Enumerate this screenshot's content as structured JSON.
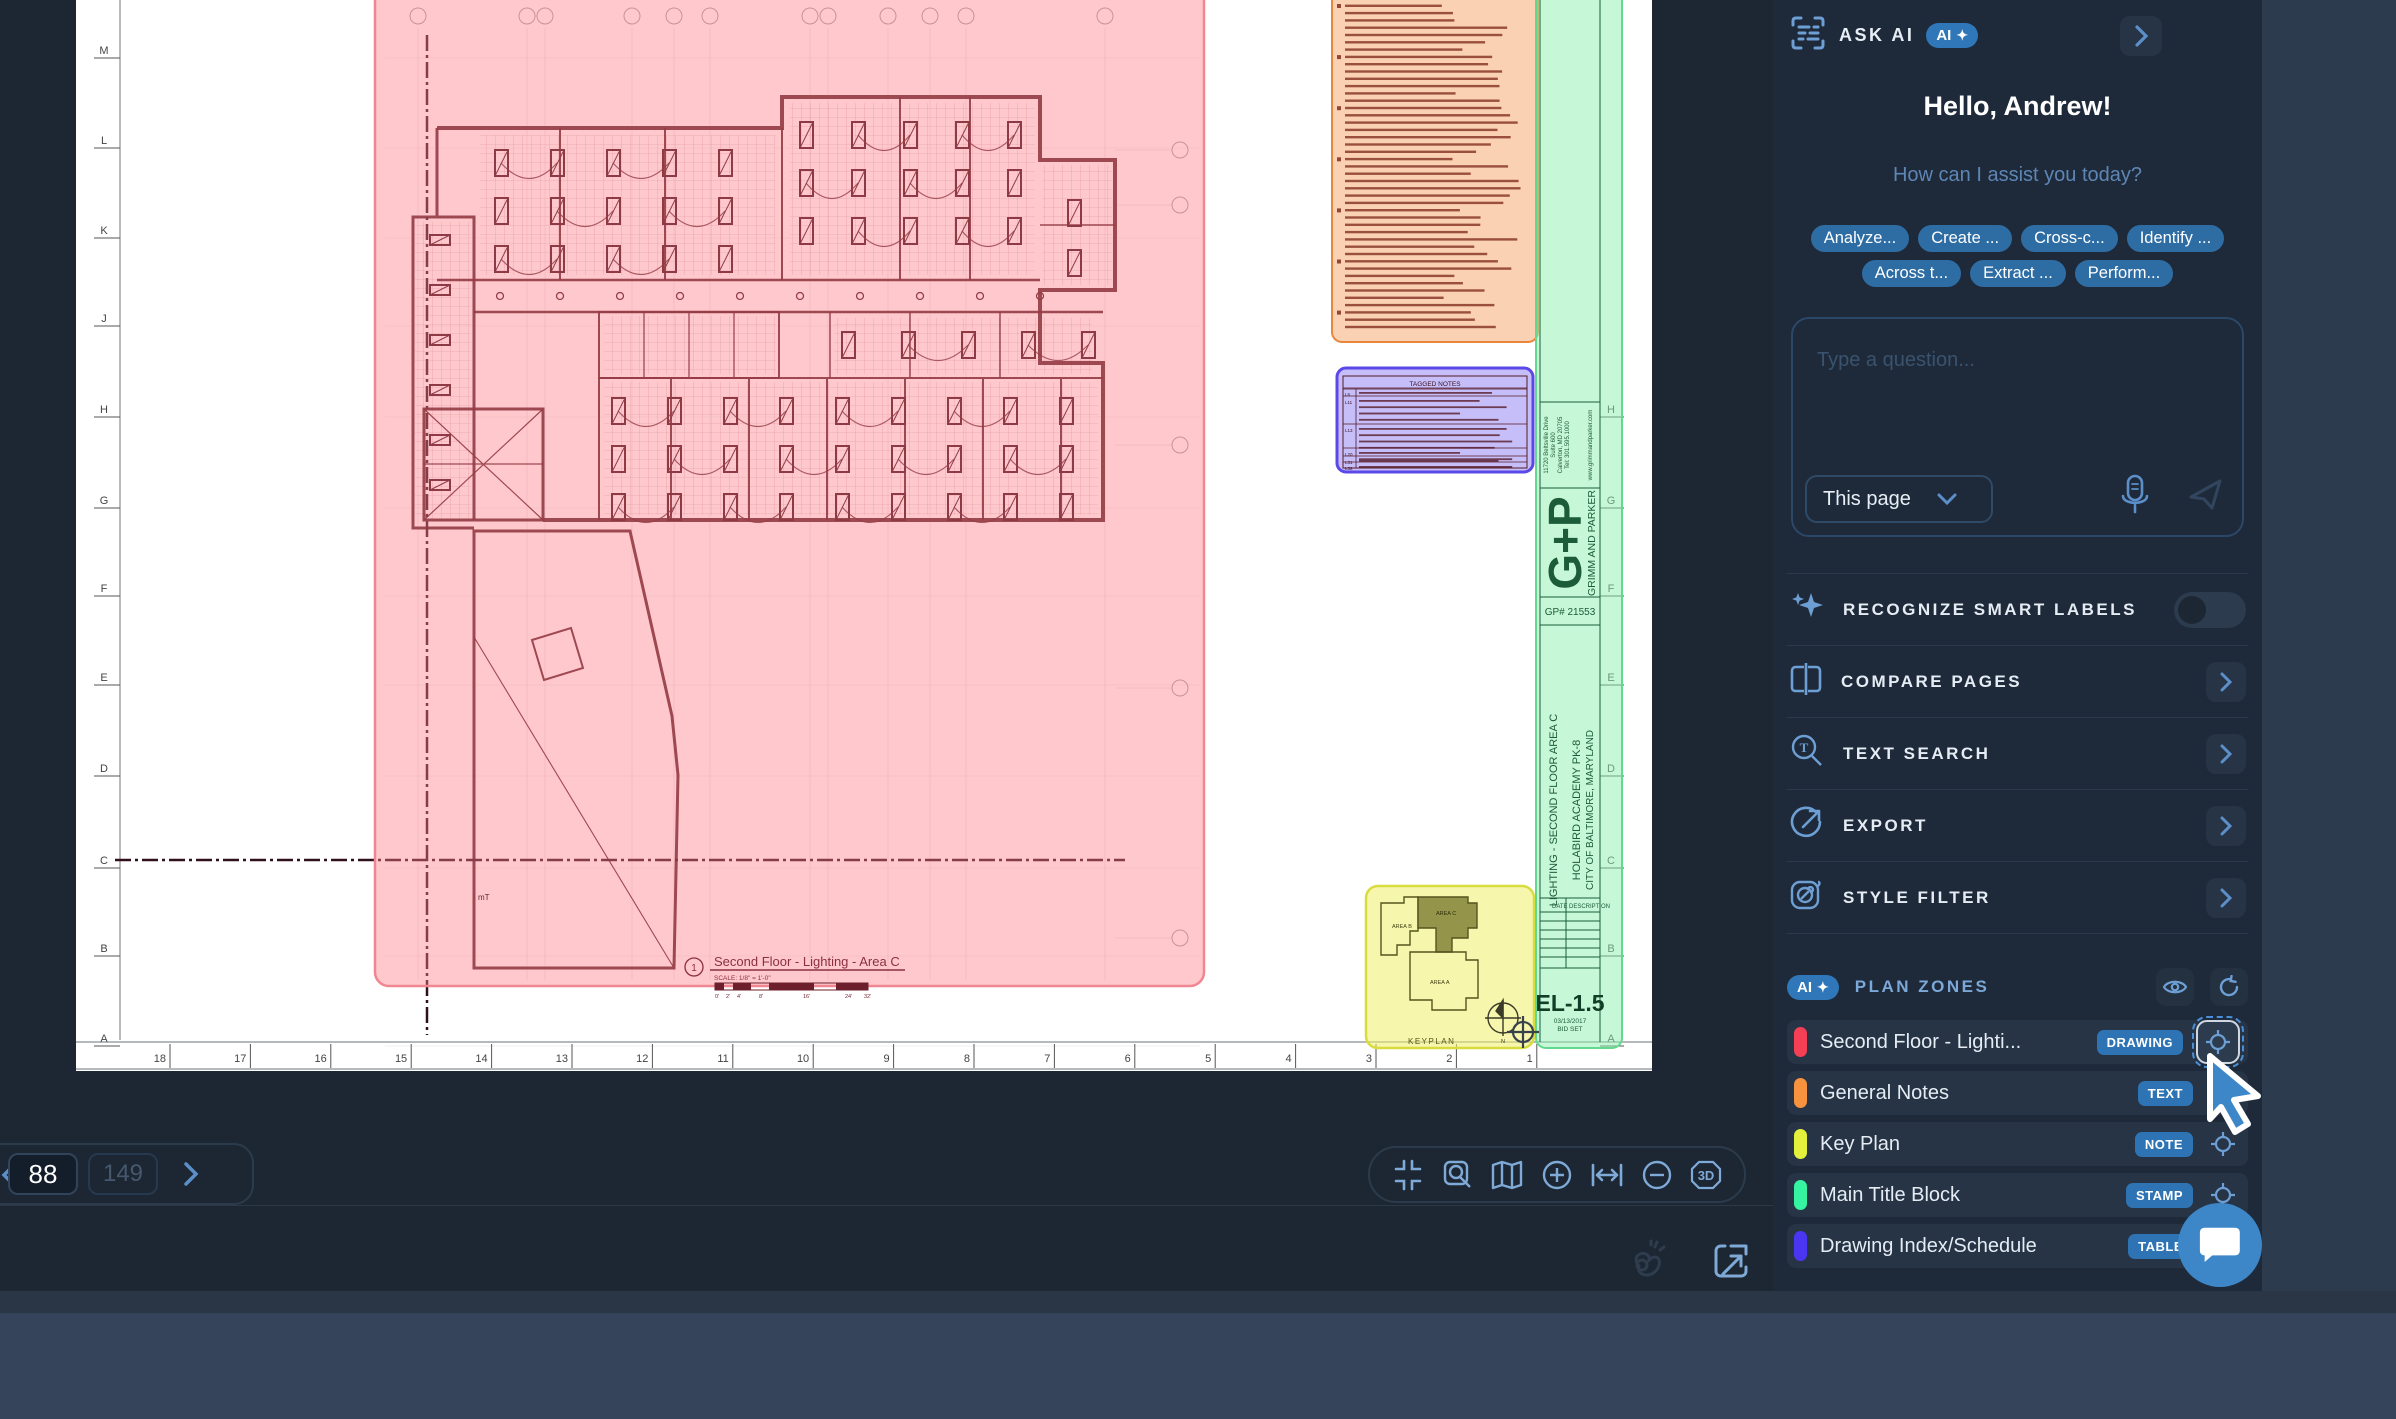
{
  "sidebar": {
    "header": {
      "title": "ASK AI",
      "badge": "AI"
    },
    "greeting": "Hello, Andrew!",
    "subtitle": "How can I assist you today?",
    "suggestions": [
      "Analyze...",
      "Create ...",
      "Cross-c...",
      "Identify ...",
      "Across t...",
      "Extract ...",
      "Perform..."
    ],
    "question": {
      "placeholder": "Type a question...",
      "scope": "This page"
    },
    "features": [
      {
        "label": "RECOGNIZE SMART LABELS",
        "control": "toggle",
        "toggle_on": false
      },
      {
        "label": "COMPARE PAGES",
        "control": "chevron"
      },
      {
        "label": "TEXT SEARCH",
        "control": "chevron"
      },
      {
        "label": "EXPORT",
        "control": "chevron"
      },
      {
        "label": "STYLE FILTER",
        "control": "chevron"
      }
    ],
    "plan_zones": {
      "badge": "AI",
      "title": "PLAN ZONES",
      "zones": [
        {
          "name": "Second Floor - Lighti...",
          "type": "DRAWING",
          "color": "#f43f54",
          "focused": true
        },
        {
          "name": "General Notes",
          "type": "TEXT",
          "color": "#f7923e",
          "focused": false
        },
        {
          "name": "Key Plan",
          "type": "NOTE",
          "color": "#e4f13c",
          "focused": false
        },
        {
          "name": "Main Title Block",
          "type": "STAMP",
          "color": "#35f3a0",
          "focused": false
        },
        {
          "name": "Drawing Index/Schedule",
          "type": "TABLE",
          "color": "#4a36f2",
          "focused": false
        }
      ]
    }
  },
  "bottom_bar": {
    "page_current": "88",
    "page_total": "149"
  },
  "canvas": {
    "page": {
      "grid_letters_left": [
        "M",
        "L",
        "K",
        "J",
        "H",
        "G",
        "F",
        "E",
        "D",
        "C",
        "B",
        "A"
      ],
      "grid_letters_right": [
        "H",
        "G",
        "F",
        "E",
        "D",
        "C",
        "B",
        "A"
      ],
      "grid_numbers": [
        "18",
        "17",
        "16",
        "15",
        "14",
        "13",
        "12",
        "11",
        "10",
        "9",
        "8",
        "7",
        "6",
        "5",
        "4",
        "3",
        "2",
        "1"
      ],
      "drawing_label": {
        "number": "1",
        "title": "Second Floor - Lighting - Area C",
        "scale": "SCALE: 1/8\" = 1'-0\""
      },
      "scale_ticks": [
        "0'",
        "2'",
        "4'",
        "8'",
        "16'",
        "24'",
        "32'"
      ],
      "small_label": "mT"
    },
    "title_block": {
      "address_lines": [
        "11720 Beltsville Drive",
        "Suite 600",
        "Calverton, MD 20705",
        "Tel: 301.595.1000"
      ],
      "website": "www.grimmandparker.com",
      "logo": "G+P",
      "firm": "GRIMM AND PARKER",
      "project_number": "GP# 21553",
      "sheet_title": "LIGHTING - SECOND FLOOR AREA C",
      "project": "HOLABIRD ACADEMY PK-8",
      "location": "CITY OF BALTIMORE, MARYLAND",
      "rev_date_header": "DATE",
      "rev_desc_header": "DESCRIPTION",
      "sheet_number": "EL-1.5",
      "sheet_date": "03/13/2017",
      "sheet_set": "BID SET"
    },
    "tagged_notes": {
      "title": "TAGGED NOTES",
      "tags": [
        "L5",
        "L11",
        "L13",
        "L20",
        "L31",
        "L32"
      ]
    },
    "keyplan": {
      "label": "KEYPLAN",
      "area_b": "AREA B",
      "area_c": "AREA C",
      "area_a": "AREA A",
      "north": "N"
    }
  },
  "colors": {
    "accent": "#3d87c8",
    "zone_pink": "#ff7d87",
    "zone_orange": "#f59a55",
    "zone_purple": "#8678f0",
    "zone_yellow": "#eef06a",
    "zone_green": "#8ef0b0"
  }
}
